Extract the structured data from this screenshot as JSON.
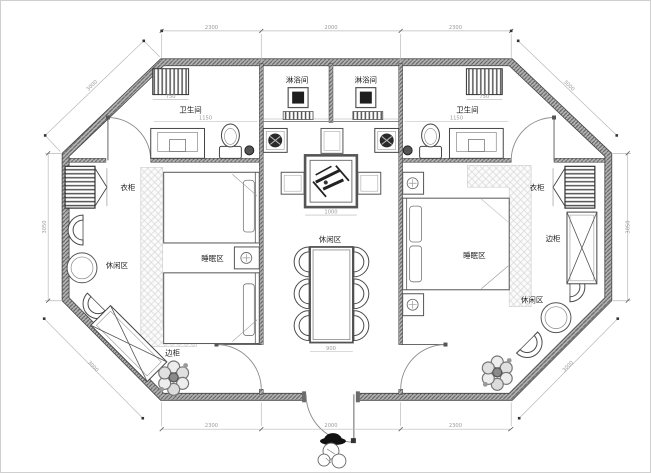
{
  "drawing": {
    "type": "architectural-floor-plan",
    "labels": {
      "bathroom_left": "卫生间",
      "bathroom_right": "卫生间",
      "shower_left": "淋浴间",
      "shower_right": "淋浴间",
      "wardrobe_left": "衣柜",
      "wardrobe_right": "衣柜",
      "side_cabinet_left": "边柜",
      "side_cabinet_right": "边柜",
      "sleeping_left": "睡眠区",
      "sleeping_right": "睡眠区",
      "lounge_left": "休闲区",
      "lounge_right": "休闲区",
      "lounge_center": "休闲区"
    },
    "dimensions": {
      "top": [
        "2300",
        "2000",
        "2300"
      ],
      "bottom": [
        "2300",
        "2000",
        "2300"
      ],
      "left": "3050",
      "right": "3050",
      "diag_top_left": "3000",
      "diag_top_right": "3000",
      "diag_bottom_left": "3000",
      "diag_bottom_right": "3000",
      "center_table": "1000",
      "dining_table": "900",
      "heater_left": "750",
      "heater_right": "750",
      "bath_left": "1150",
      "bath_right": "1150"
    },
    "colors": {
      "wall_fill": "#b3b3b3",
      "wall_hatch": "#5a5a5a",
      "line": "#3c3c3c",
      "dim": "#9a9a9a",
      "rug_hatch": "#d6d6d6"
    }
  }
}
